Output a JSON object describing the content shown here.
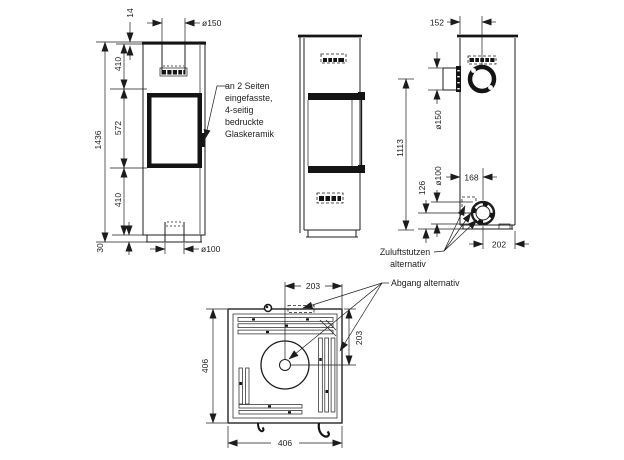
{
  "views": {
    "front": {
      "dims": {
        "total_height": "1436",
        "top_inset": "14",
        "upper": "410",
        "window": "572",
        "lower": "410",
        "plinth": "30",
        "flue_top": "ø150",
        "flue_bottom": "ø100"
      },
      "glass_note_lines": [
        "an 2 Seiten",
        "eingefasste,",
        "4-seitig",
        "bedruckte",
        "Glaskeramik"
      ]
    },
    "rear": {
      "dims": {
        "flue_offset_x": "152",
        "flue_side_dia": "ø150",
        "flue_height": "1113",
        "air_inlet_height": "126",
        "air_inlet_dia": "ø100",
        "air_inlet_offset_x": "168",
        "air_inlet_offset_right": "202"
      },
      "labels": {
        "zuluft_line1": "Zuluftstutzen",
        "zuluft_line2": "alternativ"
      }
    },
    "top": {
      "dims": {
        "depth": "406",
        "width": "406",
        "flue_center_x": "203",
        "flue_center_y": "203"
      },
      "labels": {
        "abgang": "Abgang alternativ"
      }
    }
  }
}
